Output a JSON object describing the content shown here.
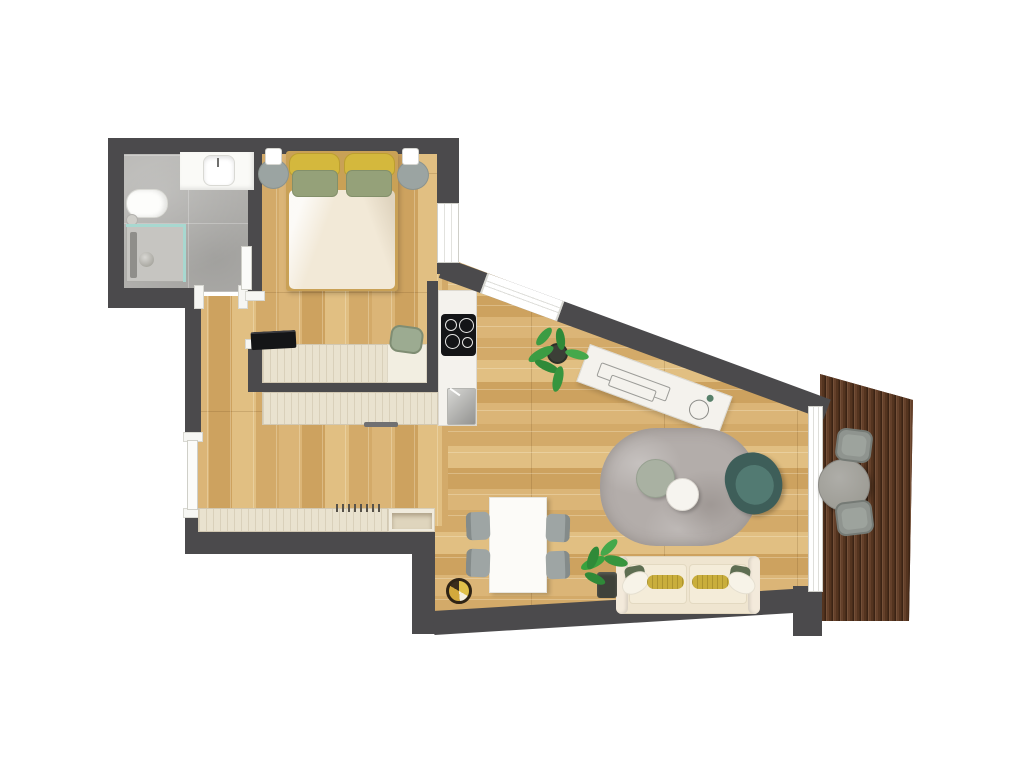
{
  "plan": {
    "type": "apartment-floor-plan-3d-top-view",
    "visible_text": [],
    "rooms": [
      {
        "id": "bathroom",
        "floor_material": "gray-stone-tile",
        "items": [
          "vanity-counter",
          "wash-basin",
          "toilet",
          "toilet-brush",
          "walk-in-shower",
          "shower-drain",
          "shower-glass"
        ]
      },
      {
        "id": "bedroom",
        "floor_material": "oak-wood",
        "items": [
          "double-bed",
          "yellow-pillows-x2",
          "green-pillows-x2",
          "nightstand-left",
          "nightstand-right",
          "lamp-left",
          "lamp-right",
          "dresser",
          "laptop",
          "desk-chair"
        ]
      },
      {
        "id": "kitchen",
        "floor_material": "oak-wood",
        "items": [
          "lower-cabinet-run",
          "cabinet-handle",
          "cooktop-4-burner",
          "sink",
          "island-counter",
          "island-sink",
          "island-tap",
          "potted-plant"
        ]
      },
      {
        "id": "hallway",
        "floor_material": "oak-wood",
        "items": [
          "entry-sideboard",
          "sideboard-cubby",
          "radiator-grille"
        ]
      },
      {
        "id": "living-dining",
        "floor_material": "oak-wood",
        "items": [
          "dining-table",
          "dining-chairs-x4",
          "area-rug",
          "coffee-table-large",
          "coffee-table-small",
          "armchair",
          "sofa-two-seat",
          "sofa-yellow-bolsters-x2",
          "sofa-white-pillows-x2",
          "sofa-green-pillows-x2",
          "potted-plant",
          "floor-clock"
        ]
      },
      {
        "id": "balcony",
        "floor_material": "dark-wood-decking",
        "items": [
          "bistro-table",
          "balcony-chair-upper",
          "balcony-chair-lower"
        ]
      }
    ],
    "openings": {
      "windows": [
        "bedroom-window-right-wall",
        "diagonal-wall-window"
      ],
      "doors": [
        "entry-door",
        "bathroom-door",
        "bedroom-doorway",
        "balcony-sliding-glass-door"
      ]
    },
    "colors": {
      "wall": "#4b4a4c",
      "wood_base": "#d7ae6c",
      "tile": "#b5b4b1",
      "deck": "#5d3a25",
      "cabinet": "#e9e2cf",
      "counter_white": "#f4f2ed",
      "rug_gray": "#b3adaa",
      "sofa_cream": "#efe5d0",
      "pillow_yellow": "#d4b83d",
      "pillow_green": "#95a179",
      "armchair_teal": "#3e5e59",
      "chair_gray": "#9ea5a4",
      "plant_green": "#3c9c43",
      "duvet_cream": "#f2e9d7",
      "nightstand_gray": "#9ba4a2",
      "shower_glass": "#a8d8d0",
      "bed_frame": "#c9a156",
      "cooktop_black": "#141517",
      "outside": "#ffffff"
    }
  }
}
